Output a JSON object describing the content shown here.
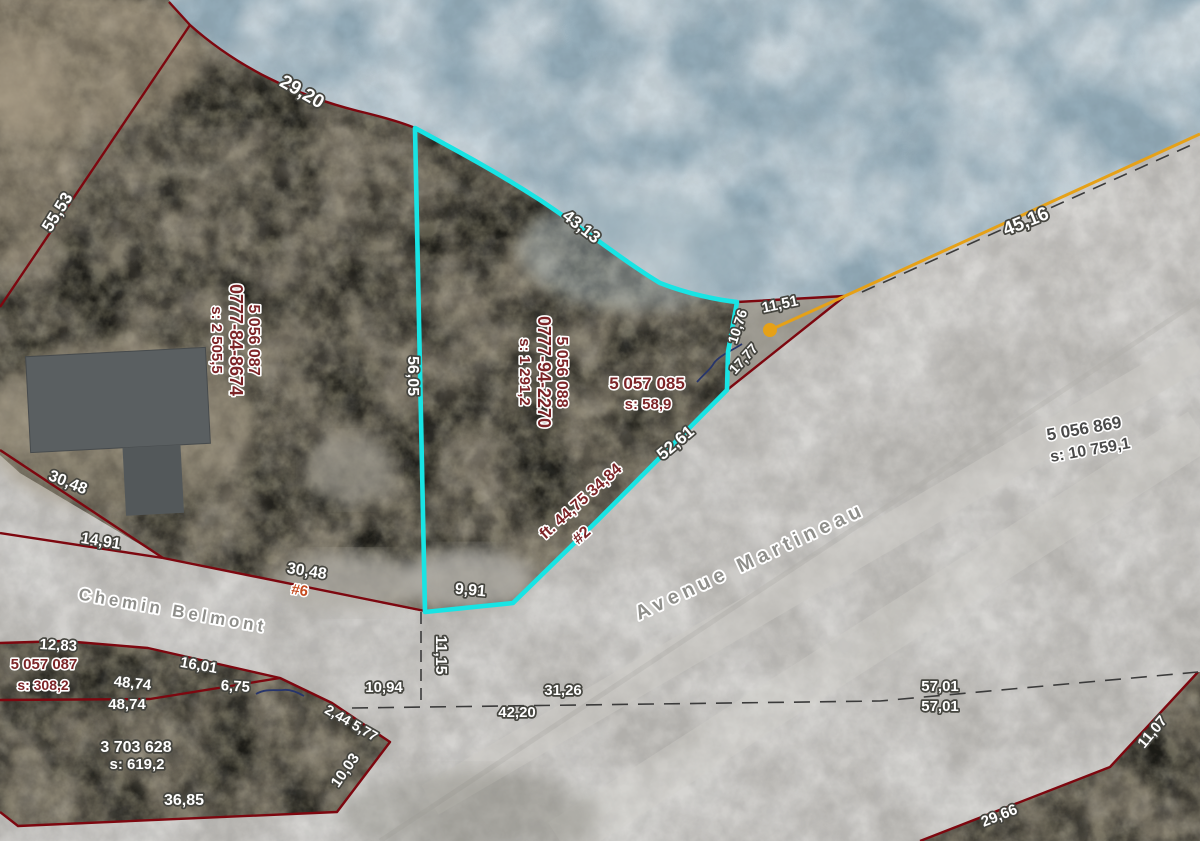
{
  "map": {
    "type": "cadastral-aerial-map",
    "selected_parcel": {
      "lot_number": "5 056 088",
      "matricule": "0777-94-2270",
      "area": "s: 1 291,2",
      "outline_color": "#18e4e4"
    },
    "colors": {
      "water": "#93abb8",
      "forest": "#5d5a4b",
      "road_sand": "#c1bfbb",
      "boundary": "#7d070f",
      "selected_outline": "#18e4e4",
      "marker_orange": "#e6a117",
      "hydro_navy": "#27356b"
    },
    "streets": [
      "Avenue Martineau",
      "Chemin Belmont"
    ],
    "marker": {
      "shape": "circle-with-leader-line",
      "color": "#e6a117"
    }
  },
  "parcel_blocks": [
    {
      "n": "parcel-info-block",
      "lines": [
        "5 056 087",
        "0777-84-8674",
        "s: 2 505,5"
      ],
      "x": 230,
      "y": 340,
      "r": 90,
      "fs": [
        16,
        18,
        15
      ]
    },
    {
      "n": "parcel-info-block",
      "lines": [
        "5 056 088",
        "0777-94-2270",
        "s: 1 291,2"
      ],
      "x": 538,
      "y": 372,
      "r": 90,
      "fs": [
        16,
        18,
        15
      ]
    }
  ],
  "map_labels": [
    {
      "n": "measurement-label",
      "t": "29,20",
      "x": 299,
      "y": 97,
      "r": 30,
      "s": "white",
      "fs": 19
    },
    {
      "n": "measurement-label",
      "t": "55,53",
      "x": 62,
      "y": 215,
      "r": -58,
      "s": "white",
      "fs": 17
    },
    {
      "n": "measurement-label",
      "t": "43,13",
      "x": 578,
      "y": 231,
      "r": 38,
      "s": "white",
      "fs": 17
    },
    {
      "n": "measurement-label",
      "t": "56,05",
      "x": 408,
      "y": 376,
      "r": 90,
      "s": "white",
      "fs": 16
    },
    {
      "n": "measurement-label",
      "t": "9,91",
      "x": 470,
      "y": 595,
      "r": 5,
      "s": "white",
      "fs": 16
    },
    {
      "n": "measurement-label",
      "t": "11,15",
      "x": 436,
      "y": 655,
      "r": 90,
      "s": "white",
      "fs": 16
    },
    {
      "n": "measurement-label",
      "t": "11,51",
      "x": 781,
      "y": 309,
      "r": -12,
      "s": "white",
      "fs": 15
    },
    {
      "n": "measurement-label",
      "t": "10,76",
      "x": 742,
      "y": 328,
      "r": -72,
      "s": "white",
      "fs": 14
    },
    {
      "n": "measurement-label",
      "t": "17,77",
      "x": 747,
      "y": 362,
      "r": -48,
      "s": "white",
      "fs": 14
    },
    {
      "n": "measurement-label",
      "t": "45,16",
      "x": 1028,
      "y": 227,
      "r": -22,
      "s": "white",
      "fs": 19
    },
    {
      "n": "measurement-label",
      "t": "52,61",
      "x": 679,
      "y": 447,
      "r": -40,
      "s": "white",
      "fs": 17
    },
    {
      "n": "measurement-label",
      "t": "ft. 44,75 34,84",
      "x": 584,
      "y": 505,
      "r": -42,
      "s": "maroon",
      "fs": 16
    },
    {
      "n": "civic-number-label",
      "t": "#2",
      "x": 585,
      "y": 539,
      "r": -42,
      "s": "maroon",
      "fs": 16
    },
    {
      "n": "parcel-id-label",
      "t": "5 057 085",
      "x": 647,
      "y": 389,
      "r": 0,
      "s": "maroon",
      "fs": 17
    },
    {
      "n": "lot-area-label",
      "t": "s: 58,9",
      "x": 648,
      "y": 409,
      "r": 0,
      "s": "maroon",
      "fs": 15
    },
    {
      "n": "parcel-id-label",
      "t": "5 056 869",
      "x": 1085,
      "y": 434,
      "r": -10,
      "s": "dark",
      "fs": 17
    },
    {
      "n": "lot-area-label",
      "t": "s: 10 759,1",
      "x": 1091,
      "y": 455,
      "r": -10,
      "s": "dark",
      "fs": 16
    },
    {
      "n": "street-name-label",
      "t": "Avenue Martineau",
      "x": 753,
      "y": 567,
      "r": -25,
      "s": "street",
      "fs": 20,
      "ls": 5
    },
    {
      "n": "street-name-label",
      "t": "Chemin Belmont",
      "x": 172,
      "y": 616,
      "r": 10,
      "s": "street",
      "fs": 17,
      "ls": 4
    },
    {
      "n": "measurement-label",
      "t": "30,48",
      "x": 66,
      "y": 487,
      "r": 22,
      "s": "white",
      "fs": 16
    },
    {
      "n": "measurement-label",
      "t": "14,91",
      "x": 100,
      "y": 546,
      "r": 9,
      "s": "white",
      "fs": 16
    },
    {
      "n": "measurement-label",
      "t": "30,48",
      "x": 306,
      "y": 576,
      "r": 9,
      "s": "white",
      "fs": 16
    },
    {
      "n": "civic-number-label",
      "t": "#6",
      "x": 299,
      "y": 595,
      "r": 9,
      "s": "orange",
      "fs": 15
    },
    {
      "n": "measurement-label",
      "t": "12,83",
      "x": 58,
      "y": 650,
      "r": 3,
      "s": "white",
      "fs": 15
    },
    {
      "n": "parcel-id-label",
      "t": "5 057 087",
      "x": 44,
      "y": 669,
      "r": 0,
      "s": "maroon",
      "fs": 15
    },
    {
      "n": "lot-area-label",
      "t": "s: 308,2",
      "x": 43,
      "y": 690,
      "r": 0,
      "s": "maroon",
      "fs": 14
    },
    {
      "n": "measurement-label",
      "t": "16,01",
      "x": 198,
      "y": 670,
      "r": 10,
      "s": "white",
      "fs": 15
    },
    {
      "n": "measurement-label",
      "t": "48,74",
      "x": 132,
      "y": 688,
      "r": 6,
      "s": "white",
      "fs": 15
    },
    {
      "n": "measurement-label",
      "t": "6,75",
      "x": 235,
      "y": 691,
      "r": 4,
      "s": "white",
      "fs": 15
    },
    {
      "n": "measurement-label",
      "t": "48,74",
      "x": 127,
      "y": 709,
      "r": 0,
      "s": "white",
      "fs": 15
    },
    {
      "n": "parcel-id-label",
      "t": "3 703 628",
      "x": 136,
      "y": 752,
      "r": 0,
      "s": "white",
      "fs": 16
    },
    {
      "n": "lot-area-label",
      "t": "s: 619,2",
      "x": 137,
      "y": 769,
      "r": 0,
      "s": "white",
      "fs": 15
    },
    {
      "n": "measurement-label",
      "t": "36,85",
      "x": 184,
      "y": 805,
      "r": 0,
      "s": "white",
      "fs": 16
    },
    {
      "n": "measurement-label",
      "t": "10,94",
      "x": 384,
      "y": 692,
      "r": 0,
      "s": "white",
      "fs": 15
    },
    {
      "n": "measurement-label",
      "t": "31,26",
      "x": 563,
      "y": 695,
      "r": 0,
      "s": "white",
      "fs": 15
    },
    {
      "n": "measurement-label",
      "t": "42,20",
      "x": 517,
      "y": 717,
      "r": 0,
      "s": "white",
      "fs": 15
    },
    {
      "n": "measurement-label",
      "t": "2,44 5,77",
      "x": 349,
      "y": 727,
      "r": 30,
      "s": "white",
      "fs": 14
    },
    {
      "n": "measurement-label",
      "t": "10,03",
      "x": 349,
      "y": 773,
      "r": -55,
      "s": "white",
      "fs": 15
    },
    {
      "n": "measurement-label",
      "t": "57,01",
      "x": 940,
      "y": 691,
      "r": 0,
      "s": "white",
      "fs": 15
    },
    {
      "n": "measurement-label",
      "t": "57,01",
      "x": 940,
      "y": 711,
      "r": 0,
      "s": "white",
      "fs": 15
    },
    {
      "n": "measurement-label",
      "t": "11,07",
      "x": 1156,
      "y": 735,
      "r": -50,
      "s": "white",
      "fs": 15
    },
    {
      "n": "measurement-label",
      "t": "29,66",
      "x": 1001,
      "y": 820,
      "r": -22,
      "s": "white",
      "fs": 15
    }
  ]
}
